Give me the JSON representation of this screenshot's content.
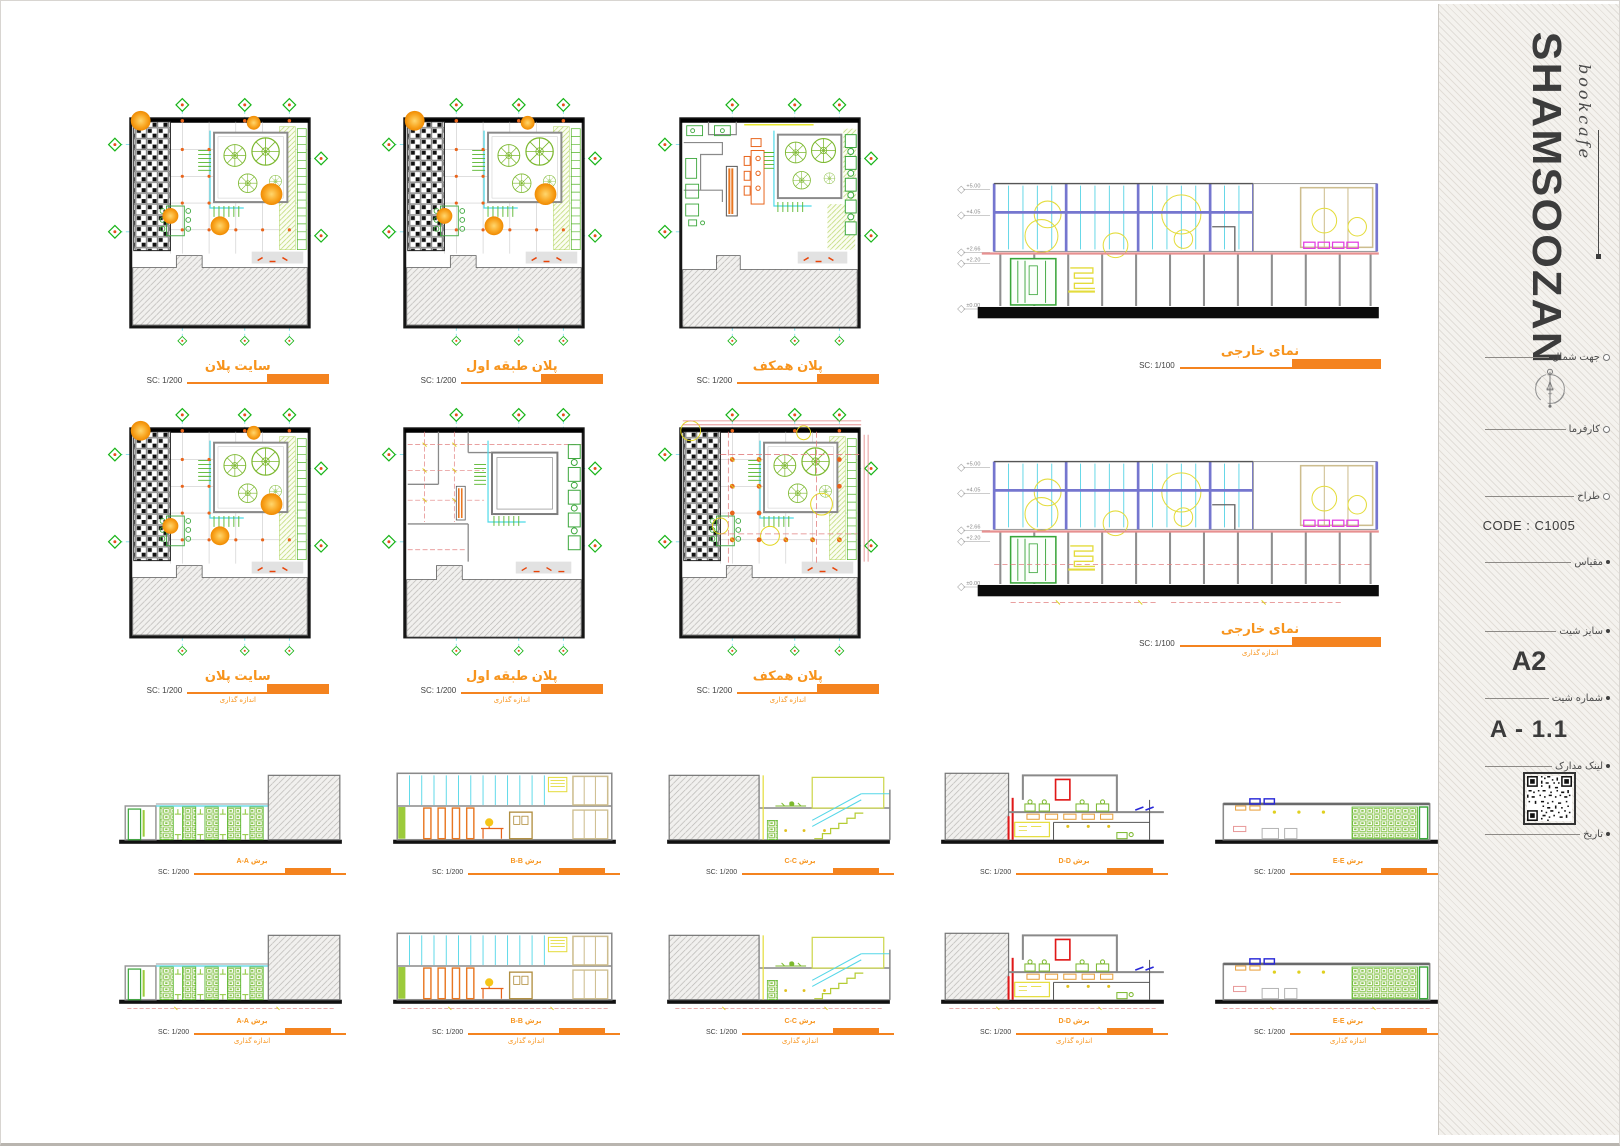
{
  "colors": {
    "accent_orange": "#F4831F",
    "title_orange": "#F7941D",
    "cad_green": "#56b52a",
    "cad_cyan": "#4dd9e8"
  },
  "sheet": {
    "elevation_levels": [
      "+5.00",
      "+4.05",
      "+2.66",
      "+2.20",
      "±0.00"
    ],
    "figures": [
      {
        "title": "سایت پلان",
        "scale": "SC: 1/200",
        "subtitle": ""
      },
      {
        "title": "پلان طبقه اول",
        "scale": "SC: 1/200",
        "subtitle": ""
      },
      {
        "title": "پلان همکف",
        "scale": "SC: 1/200",
        "subtitle": ""
      },
      {
        "title": "نمای خارجی",
        "scale": "SC: 1/100",
        "subtitle": ""
      },
      {
        "title": "سایت پلان",
        "scale": "SC: 1/200",
        "subtitle": "اندازه گذاری"
      },
      {
        "title": "پلان طبقه اول",
        "scale": "SC: 1/200",
        "subtitle": "اندازه گذاری"
      },
      {
        "title": "پلان همکف",
        "scale": "SC: 1/200",
        "subtitle": "اندازه گذاری"
      },
      {
        "title": "نمای خارجی",
        "scale": "SC: 1/100",
        "subtitle": "اندازه گذاری"
      },
      {
        "title": "برش A-A",
        "scale": "SC: 1/200",
        "subtitle": ""
      },
      {
        "title": "برش B-B",
        "scale": "SC: 1/200",
        "subtitle": ""
      },
      {
        "title": "برش C-C",
        "scale": "SC: 1/200",
        "subtitle": ""
      },
      {
        "title": "برش D-D",
        "scale": "SC: 1/200",
        "subtitle": ""
      },
      {
        "title": "برش E-E",
        "scale": "SC: 1/200",
        "subtitle": ""
      },
      {
        "title": "برش A-A",
        "scale": "SC: 1/200",
        "subtitle": "اندازه گذاری"
      },
      {
        "title": "برش B-B",
        "scale": "SC: 1/200",
        "subtitle": "اندازه گذاری"
      },
      {
        "title": "برش C-C",
        "scale": "SC: 1/200",
        "subtitle": "اندازه گذاری"
      },
      {
        "title": "برش D-D",
        "scale": "SC: 1/200",
        "subtitle": "اندازه گذاری"
      },
      {
        "title": "برش E-E",
        "scale": "SC: 1/200",
        "subtitle": "اندازه گذاری"
      }
    ]
  },
  "sidebar": {
    "brand": "SHAMSOOZAN",
    "brand_script": "bookcafe",
    "north_label": "جهت شمال",
    "client_label": "کارفرما",
    "designer_label": "طراح",
    "designer_code": "CODE : C1005",
    "scale_label": "مقیاس",
    "sheet_size_label": "سایز شیت",
    "sheet_size_value": "A2",
    "sheet_number_label": "شماره شیت",
    "sheet_number_value": "A - 1.1",
    "documents_link_label": "لینک مدارک",
    "date_label": "تاریخ"
  }
}
